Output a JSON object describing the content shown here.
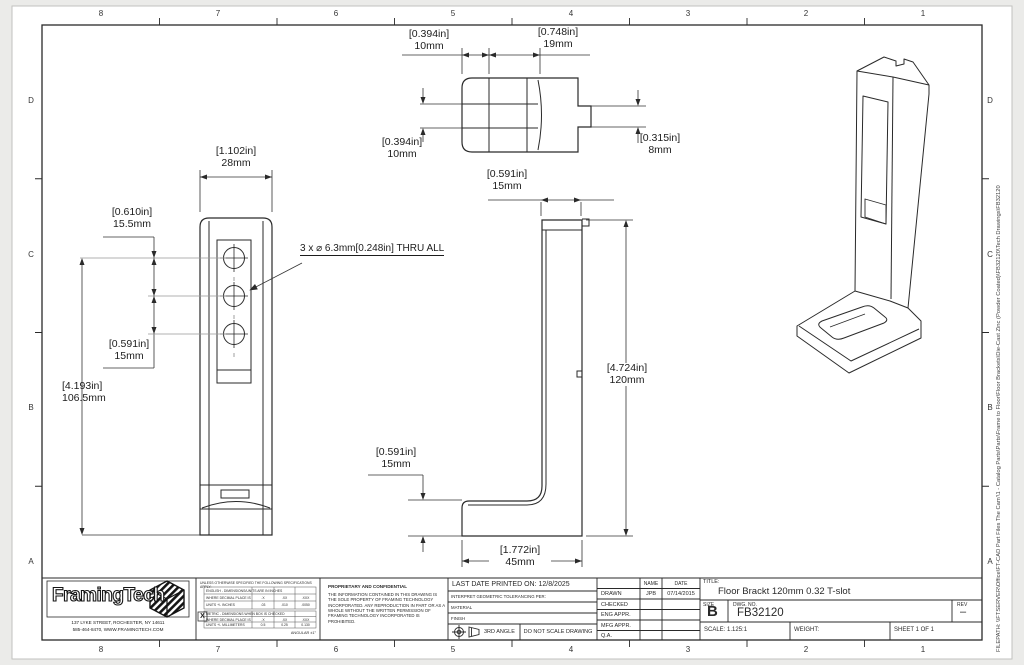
{
  "zones": {
    "cols": [
      "8",
      "7",
      "6",
      "5",
      "4",
      "3",
      "2",
      "1"
    ],
    "rows": [
      "D",
      "C",
      "B",
      "A"
    ]
  },
  "filepath": "FILEPATH: \\\\FTSERVER\\Office\\FT-CAD Part Files The Cam'\\1 - Catalog Parts\\Parts\\Frame to Floor\\Floor Brackets\\Die-Cast Zinc (Powder Coated)\\FB32120\\Tech Drawings\\FB32120",
  "views": {
    "top": {
      "w1_in": "[0.394in]",
      "w1_mm": "10mm",
      "w2_in": "[0.748in]",
      "w2_mm": "19mm",
      "slot_in": "[0.394in]",
      "slot_mm": "10mm",
      "tab_in": "[0.315in]",
      "tab_mm": "8mm"
    },
    "front": {
      "width_in": "[1.102in]",
      "width_mm": "28mm",
      "top_in": "[0.610in]",
      "top_mm": "15.5mm",
      "pitch_in": "[0.591in]",
      "pitch_mm": "15mm",
      "height_in": "[4.193in]",
      "height_mm": "106.5mm",
      "hole_note": "3 x ⌀ 6.3mm[0.248in] THRU ALL"
    },
    "side": {
      "top_in": "[0.591in]",
      "top_mm": "15mm",
      "height_in": "[4.724in]",
      "height_mm": "120mm",
      "base_in": "[0.591in]",
      "base_mm": "15mm",
      "depth_in": "[1.772in]",
      "depth_mm": "45mm"
    }
  },
  "title_block": {
    "logo_text": "FramingTech",
    "address1": "137 LYKE STREET, ROCHESTER, NY 14611",
    "address2": "585-464-8470, WWW.FRAMINGTECH.COM",
    "tolerance": {
      "heading": "UNLESS OTHERWISE SPECIFIED THE FOLLOWING SPECIFICATIONS APPLY:",
      "english_title": "ENGLISH - DIMENSIONS/UNITS ARE IN INCHES",
      "place_label": "WHERE DECIMAL PLACE IS",
      "col1": ".X",
      "col2": ".XX",
      "col3": ".XXX",
      "english_units": "UNITS +/- INCHES",
      "e1": ".03",
      "e2": ".010",
      "e3": ".0050",
      "metric_title": "METRIC - DIMENSIONS WHEN BOX IS CHECKED",
      "metric_units": "UNITS +/- MILLIMETERS",
      "m1": "0.5",
      "m2": "0.25",
      "m3": "0.130",
      "angular": "ANGULAR ±1°",
      "checkbox": "X"
    },
    "proprietary": {
      "heading": "PROPRIETARY AND CONFIDENTIAL",
      "body": "THE INFORMATION CONTAINED IN THIS DRAWING IS THE SOLE PROPERTY OF FRAMING TECHNOLOGY INCORPORATED.  ANY REPRODUCTION IN PART OR AS A WHOLE WITHOUT THE WRITTEN PERMISSION OF FRAMING TECHNOLOGY INCORPORATED IS PROHIBITED."
    },
    "info": {
      "last_printed": "LAST DATE PRINTED ON: 12/8/2025",
      "interpret": "INTERPRET GEOMETRIC TOLERANCING PER:",
      "material": "MATERIAL",
      "finish": "FINISH",
      "angle": "3RD ANGLE",
      "do_not_scale": "DO NOT SCALE DRAWING"
    },
    "approvals": {
      "name_h": "NAME",
      "date_h": "DATE",
      "r1": "DRAWN",
      "r1_name": "JPB",
      "r1_date": "07/14/2015",
      "r2": "CHECKED",
      "r3": "ENG APPR.",
      "r4": "MFG APPR.",
      "r5": "Q.A."
    },
    "title": {
      "label": "TITLE:",
      "value": "Floor Brackt 120mm 0.32 T-slot",
      "size_label": "SIZE",
      "size": "B",
      "dwg_label": "DWG. NO.",
      "dwg": "FB32120",
      "rev_label": "REV",
      "rev": "–",
      "scale": "SCALE: 1.125:1",
      "weight": "WEIGHT:",
      "sheet": "SHEET 1 OF 1"
    }
  }
}
